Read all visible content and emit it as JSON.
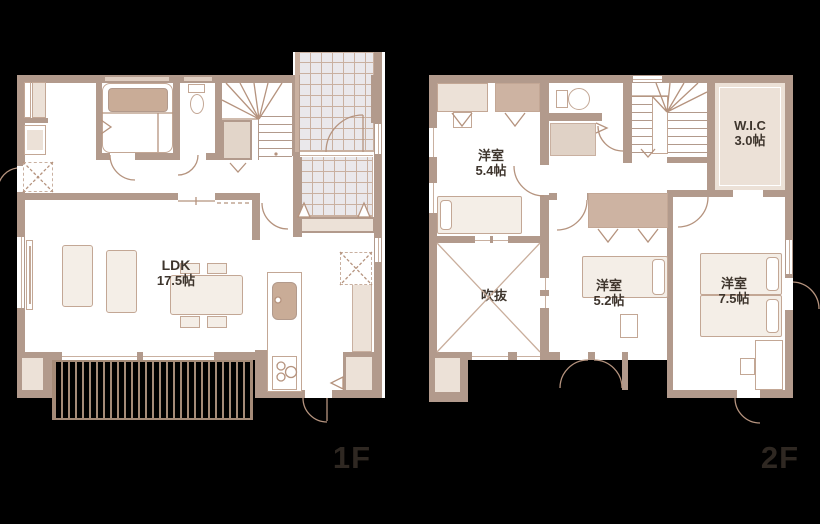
{
  "title": "House floor plan 1F / 2F",
  "floors": [
    {
      "id": "1f",
      "label": "1F",
      "rooms": [
        {
          "name": "ldk",
          "line1": "LDK",
          "line2": "17.5帖"
        }
      ],
      "fixtures": [
        "bathtub-icon",
        "toilet-icon",
        "washbasin-icon",
        "kitchen-sink-icon",
        "stove-icon",
        "stairs-icon",
        "entrance-tile",
        "wood-deck",
        "dining-table",
        "sofa",
        "tv-board",
        "underfloor-hatch"
      ]
    },
    {
      "id": "2f",
      "label": "2F",
      "rooms": [
        {
          "name": "bedroom-5-4",
          "line1": "洋室",
          "line2": "5.4帖"
        },
        {
          "name": "void",
          "line1": "吹抜",
          "line2": ""
        },
        {
          "name": "bedroom-5-2",
          "line1": "洋室",
          "line2": "5.2帖"
        },
        {
          "name": "bedroom-7-5",
          "line1": "洋室",
          "line2": "7.5帖"
        },
        {
          "name": "wic",
          "line1": "W.I.C",
          "line2": "3.0帖"
        }
      ],
      "fixtures": [
        "toilet-icon",
        "washbasin-cabinet",
        "stairs-icon",
        "closet",
        "bed",
        "desk",
        "void-cross"
      ]
    }
  ],
  "colors": {
    "bg": "#000000",
    "wall": "#b29a8c",
    "wallLine": "#c9b0a0",
    "floor": "#ffffff",
    "beige": "#ece1d7",
    "tan": "#cdb3a2",
    "tub": "#c9ac97",
    "tile": "#eae8eb",
    "deckLine": "#a58b78",
    "furn": "#f4eee7",
    "furnLine": "#c3a795",
    "text": "#3e352d",
    "floorLabel": "#2f2822"
  }
}
